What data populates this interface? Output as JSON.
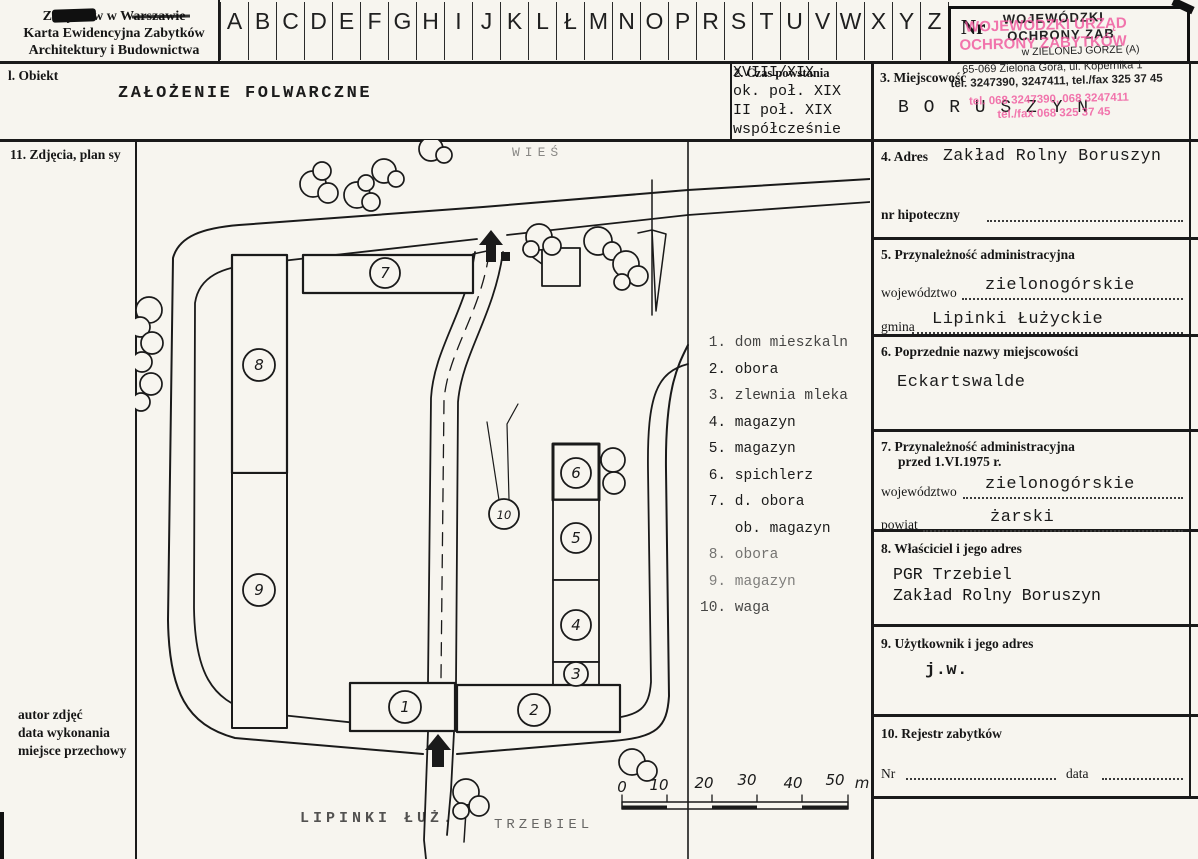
{
  "page": {
    "bg": "#f7f5ef",
    "ink": "#161616",
    "stamp_pink": "#f0559c"
  },
  "header": {
    "org_lines": [
      "Zabytków w Warszawie",
      "Karta Ewidencyjna Zabytków",
      "Architektury i Budownictwa"
    ],
    "alphabet": [
      "A",
      "B",
      "C",
      "D",
      "E",
      "F",
      "G",
      "H",
      "I",
      "J",
      "K",
      "L",
      "Ł",
      "M",
      "N",
      "O",
      "P",
      "R",
      "S",
      "T",
      "U",
      "V",
      "W",
      "X",
      "Y",
      "Z"
    ],
    "nr_label": "Nr"
  },
  "stamp": {
    "black_lines": [
      "WOJEWÓDZKI",
      "OCHRONY ZAB",
      "w ZIELONEJ GÓRZE  (A)",
      "65-069 Zielona Góra, ul. Kopernika 1",
      "tel. 3247390, 3247411, tel./fax 325 37 45"
    ],
    "pink_lines": [
      "WOJEWÓDZKI URZĄD",
      "OCHRONY ZABYTKÓW",
      "tel. 068 3247390, 068 3247411",
      "tel./fax 068 325 37 45"
    ]
  },
  "row2": {
    "s1_label": "l. Obiekt",
    "s1_value": "ZAŁOŻENIE FOLWARCZNE",
    "s2_label": "2. Czas powstania",
    "s2_lines": [
      "XVIII/XIX",
      "ok. poł. XIX",
      "II poł. XIX",
      "współcześnie"
    ],
    "s3_label": "3. Miejscowość",
    "s3_value": "B O R U S Z Y N"
  },
  "left_col": {
    "s11_label": "11. Zdjęcia, plan sy",
    "bottom_lines": [
      "autor zdjęć",
      "data wykonania",
      "miejsce przechowy"
    ]
  },
  "right_col": {
    "s4": {
      "label": "4. Adres",
      "value": "Zakład Rolny Boruszyn",
      "hip_label": "nr hipoteczny"
    },
    "s5": {
      "label": "5. Przynależność administracyjna",
      "f1_label": "województwo",
      "f1_value": "zielonogórskie",
      "f2_label": "gmina",
      "f2_value": "Lipinki Łużyckie"
    },
    "s6": {
      "label": "6. Poprzednie nazwy miejscowości",
      "value": "Eckartswalde"
    },
    "s7": {
      "label1": "7. Przynależność administracyjna",
      "label2": "przed 1.VI.1975 r.",
      "f1_label": "województwo",
      "f1_value": "zielonogórskie",
      "f2_label": "powiat",
      "f2_value": "żarski"
    },
    "s8": {
      "label": "8. Właściciel i jego adres",
      "lines": [
        "PGR Trzebiel",
        "Zakład Rolny Boruszyn"
      ]
    },
    "s9": {
      "label": "9. Użytkownik i jego adres",
      "value": "j.w."
    },
    "s10": {
      "label": "10. Rejestr zabytków",
      "nr_label": "Nr",
      "date_label": "data"
    }
  },
  "plan": {
    "village_label": "WIEŚ",
    "bottom_left_label": "LIPINKI ŁUŻ.",
    "bottom_right_label": "TRZEBIEL",
    "legend": [
      " 1. dom mieszkaln",
      " 2. obora",
      " 3. zlewnia mleka",
      " 4. magazyn",
      " 5. magazyn",
      " 6. spichlerz",
      " 7. d. obora",
      "    ob. magazyn",
      " 8. obora",
      " 9. magazyn",
      "10. waga"
    ],
    "numbers": {
      "n1": "1",
      "n2": "2",
      "n3": "3",
      "n4": "4",
      "n5": "5",
      "n6": "6",
      "n7": "7",
      "n8": "8",
      "n9": "9",
      "n10": "10"
    },
    "scale": {
      "ticks": [
        "0",
        "10",
        "20",
        "30",
        "40",
        "50"
      ],
      "unit": "m"
    }
  }
}
